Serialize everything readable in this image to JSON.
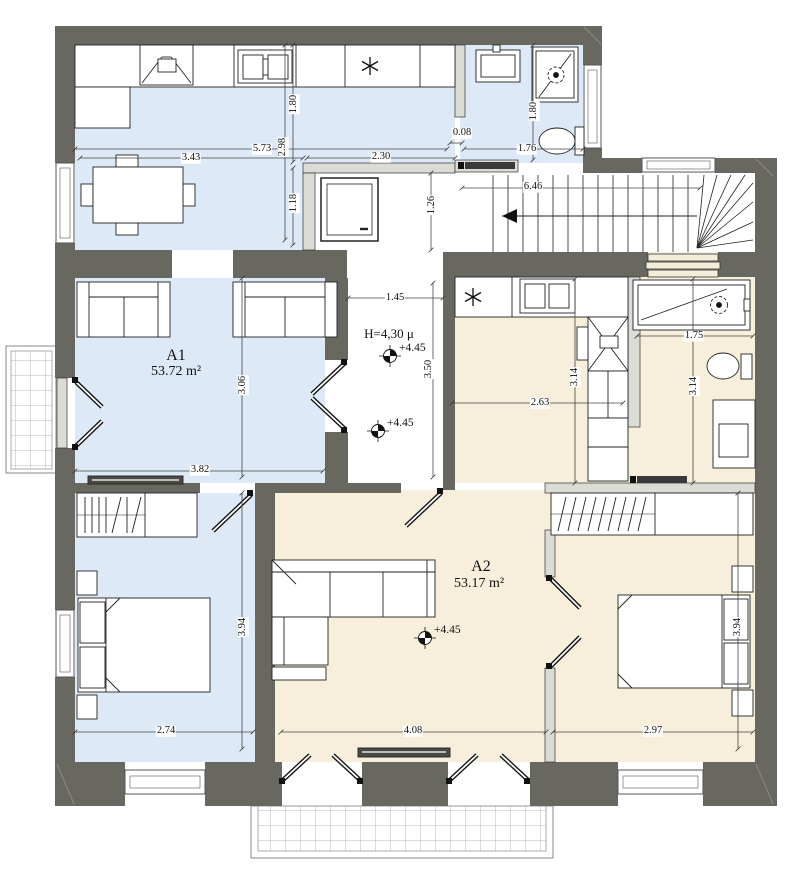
{
  "plan": {
    "units": {
      "a1": {
        "name": "A1",
        "area": "53.72 m²"
      },
      "a2": {
        "name": "A2",
        "area": "53.17 m²"
      }
    },
    "height_note": "H=4,30 μ",
    "levels": {
      "hall_upper": "+4.45",
      "hall_lower": "+4.45",
      "living": "+4.45"
    },
    "dims": {
      "w5_73": "5.73",
      "w3_43": "3.43",
      "w2_98": "2.98",
      "w1_80_kitchen": "1.80",
      "w1_18": "1.18",
      "w2_30": "2.30",
      "w0_08": "0.08",
      "w1_76": "1.76",
      "w1_80_bath": "1.80",
      "w6_46": "6.46",
      "w1_26": "1.26",
      "w1_45": "1.45",
      "w3_50": "3.50",
      "w3_06": "3.06",
      "w3_82": "3.82",
      "w2_63": "2.63",
      "w3_14_kitchen": "3.14",
      "w3_14_bath": "3.14",
      "w1_75": "1.75",
      "w3_94_a1": "3.94",
      "w3_94_a2": "3.94",
      "w2_74": "2.74",
      "w4_08": "4.08",
      "w2_97": "2.97"
    },
    "colors": {
      "wall": "#686760",
      "a1_floor": "#dde9f6",
      "a2_floor": "#f7efdb"
    }
  }
}
